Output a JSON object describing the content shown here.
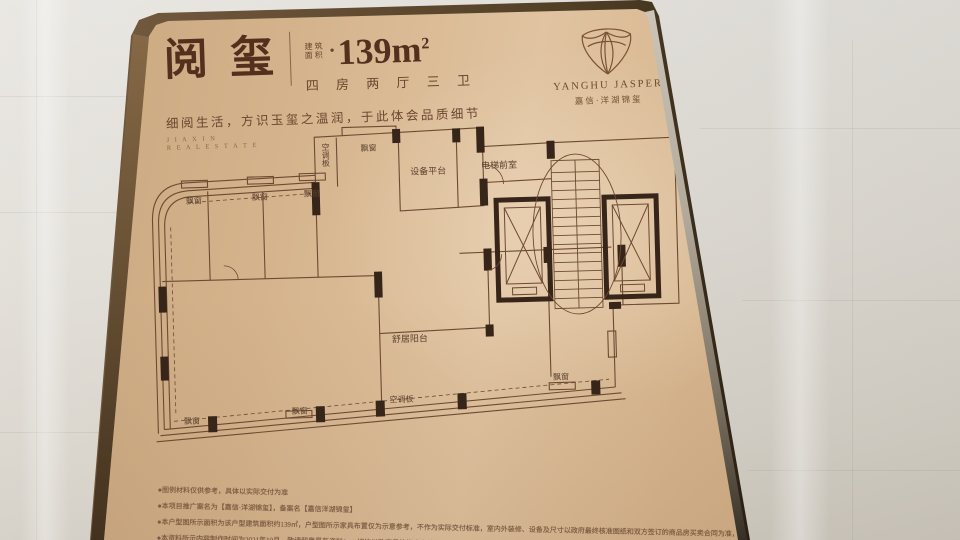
{
  "header": {
    "title": "阅玺",
    "area_label_top": "建筑",
    "area_label_bottom": "面积",
    "area_bullet": "●",
    "area_value": "139m",
    "area_sup": "2",
    "rooms": "四 房 两 厅 三 卫",
    "tagline": "细阅生活，方识玉玺之温润，于此体会品质细节",
    "english_line1": "J I A X I N",
    "english_line2": "R E A L    E S T A T E"
  },
  "brand": {
    "name_en": "YANGHU JASPER",
    "name_cn": "嘉信·洋湖锦玺"
  },
  "floorplan": {
    "labels": {
      "ac_panel": "空调板",
      "bay_window": "飘窗",
      "equipment_platform": "设备平台",
      "elevator_lobby": "电梯前室",
      "balcony": "舒居阳台"
    }
  },
  "footnotes": [
    "●图例材料仅供参考，具体以实际交付为准",
    "●本项目推广案名为【嘉信·洋湖锦玺】，备案名【嘉信洋湖锦玺】",
    "●本户型图所示面积为该户型建筑面积约139㎡，户型图所示家具布置仅为示意参考，不作为实际交付标准，室内外装修、设备及尺寸以政府最终核准图纸和双方签订的商品房买卖合同为准，不构成要约",
    "●本资料所示内容制作时间为2021年10月，敬请留意最新资料；一切均以政府最终批准文件及双方签订的商品房买卖合同之最终约定为准"
  ],
  "colors": {
    "face_gold": "#d6b58e",
    "edge_bronze": "#4a3826",
    "ink_brown": "#5d3a28",
    "wall_line": "#6e4a33",
    "wall_solid": "#362518",
    "marble": "#dedad2"
  }
}
